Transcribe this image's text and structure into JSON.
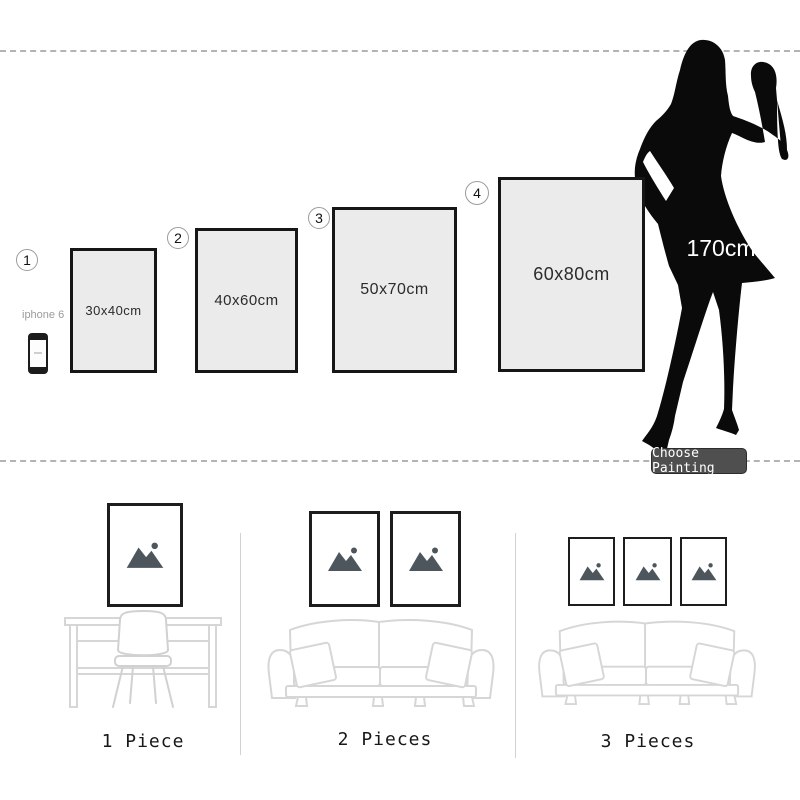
{
  "top_section": {
    "size_options": [
      {
        "number": "1",
        "size": "30x40cm"
      },
      {
        "number": "2",
        "size": "40x60cm"
      },
      {
        "number": "3",
        "size": "50x70cm"
      },
      {
        "number": "4",
        "size": "60x80cm"
      }
    ],
    "reference_phone": {
      "label": "iphone 6"
    },
    "reference_person": {
      "height_label": "170cm"
    },
    "choose_button_label": "Choose Painting"
  },
  "scene_section": {
    "scenes": [
      {
        "label": "1 Piece",
        "frame_count": 1,
        "furniture": "desk-with-chair"
      },
      {
        "label": "2 Pieces",
        "frame_count": 2,
        "furniture": "sofa"
      },
      {
        "label": "3 Pieces",
        "frame_count": 3,
        "furniture": "sofa"
      }
    ]
  },
  "icons": {
    "woman_silhouette": "standing-woman-silhouette",
    "phone": "smartphone-outline",
    "frame_art": "mountain-image-placeholder"
  },
  "colors": {
    "frame_fill": "#ebebeb",
    "frame_border": "#161616",
    "dashed_line": "#b3b3b3",
    "button_bg": "#4f4f4f",
    "button_text": "#ffffff",
    "mountain_icon": "#4d565c",
    "furniture_outline": "#d6d6d6",
    "silhouette": "#0a0a0a"
  }
}
